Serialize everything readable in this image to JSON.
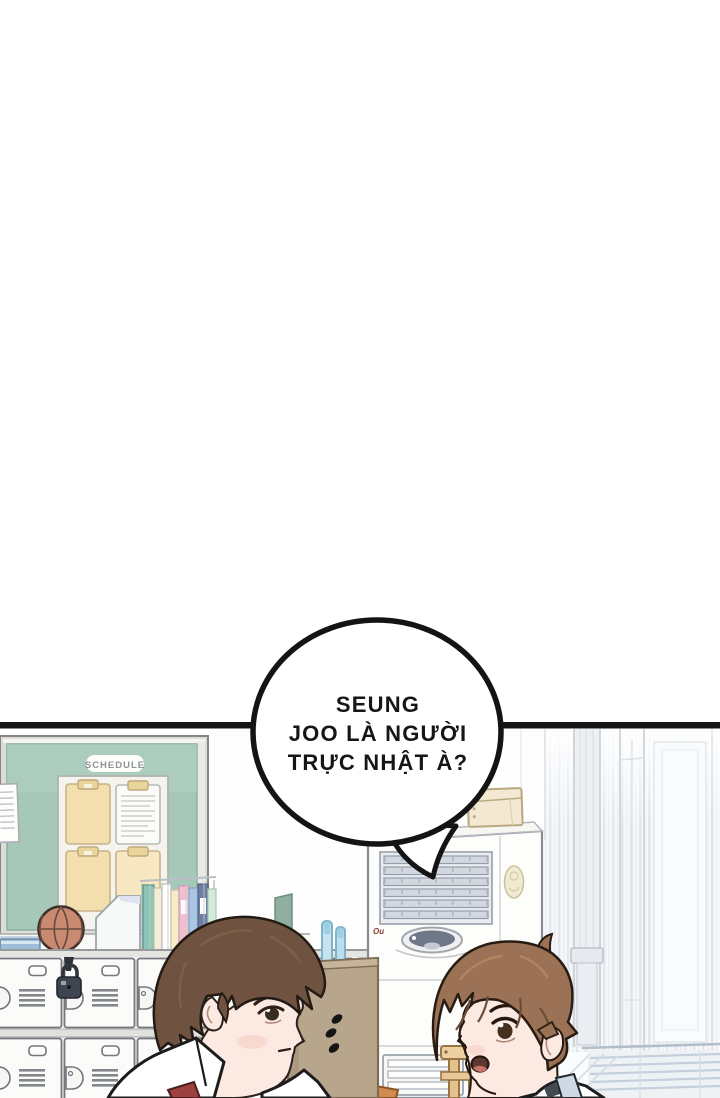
{
  "scene_type": "webtoon comic panel, classroom",
  "speech_bubble": {
    "lines": [
      "SEUNG",
      "JOO LÀ NGƯỜI",
      "TRỰC NHẬT À?"
    ],
    "text_color": "#161616",
    "fill": "#ffffff",
    "stroke": "#141414"
  },
  "board": {
    "label": "SCHEDULE"
  },
  "ac_unit": {
    "logo_text": "Ou"
  },
  "sfx": {
    "ellipsis_dot_count": 3
  },
  "colors": {
    "panel_border": "#141414",
    "board_green": "#a6c8b9",
    "clipboard_cream": "#f3dfae",
    "basketball": "#c98a72",
    "locker_white": "#fbfbf9",
    "kraft_box": "#b7a58c",
    "hair_left_character": "#6f5340",
    "hair_right_character": "#9b7256",
    "skin": "#fce9e1",
    "tie_red": "#9e4240",
    "window_stripe": "#e2e7ed",
    "collar_blue": "#cdd9e4"
  }
}
